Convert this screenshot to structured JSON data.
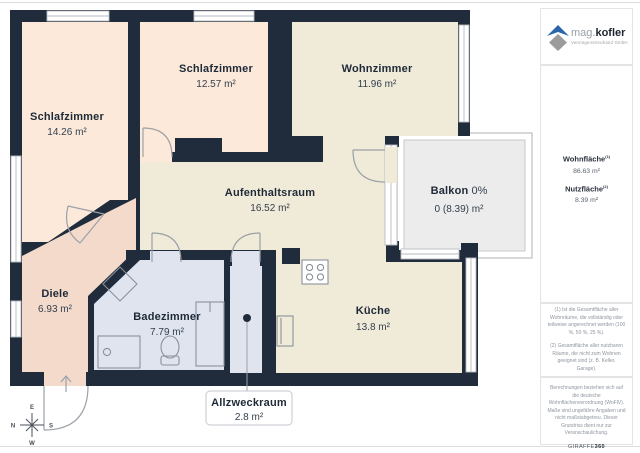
{
  "plan": {
    "rooms": [
      {
        "id": "schlafzimmer-1",
        "name": "Schlafzimmer",
        "area": "14.26 m²"
      },
      {
        "id": "schlafzimmer-2",
        "name": "Schlafzimmer",
        "area": "12.57 m²"
      },
      {
        "id": "wohnzimmer",
        "name": "Wohnzimmer",
        "area": "11.96 m²"
      },
      {
        "id": "aufenthaltsraum",
        "name": "Aufenthaltsraum",
        "area": "16.52 m²"
      },
      {
        "id": "balkon",
        "name": "Balkon",
        "percent": " 0%",
        "area": "0 (8.39) m²"
      },
      {
        "id": "diele",
        "name": "Diele",
        "area": "6.93 m²"
      },
      {
        "id": "badezimmer",
        "name": "Badezimmer",
        "area": "7.79 m²"
      },
      {
        "id": "kueche",
        "name": "Küche",
        "area": "13.8 m²"
      },
      {
        "id": "allzweckraum",
        "name": "Allzweckraum",
        "area": "2.8 m²"
      }
    ],
    "compass": {
      "n": "N",
      "e": "E",
      "s": "S",
      "w": "W"
    }
  },
  "sidebar": {
    "logo": {
      "brand_light": "mag.",
      "brand_bold": "kofler",
      "subtitle": "Vermögenstreuhand GmbH"
    },
    "metrics": [
      {
        "label": "Wohnfläche",
        "sup": "(1)",
        "value": "86.63 m²"
      },
      {
        "label": "Nutzfläche",
        "sup": "(2)",
        "value": "8.39 m²"
      }
    ],
    "footnotes": [
      "(1) Ist die Gesamtfläche aller Wohnräume, die vollständig oder teilweise angerechnet werden (100 %, 50 %, 25 %).",
      "(2) Gesamtfläche aller nutzbaren Räume, die nicht zum Wohnen geeignet sind (z. B. Keller, Garage)."
    ],
    "disclaimer": "Berechnungen beziehen sich auf die deutsche Wohnflächenverordnung (WoFlV). Maße sind ungefähre Angaben und nicht maßstabgetreu. Dieser Grundriss dient nur zur Veranschaulichung.",
    "brand_footer": {
      "name": "GIRAFFE",
      "suffix": "360"
    }
  },
  "colors": {
    "wall": "#202c3c",
    "bedroom": "#fce9d9",
    "living": "#f0ead8",
    "hall": "#f4dacb",
    "bath": "#dfe4ef",
    "balcony": "#ececec",
    "logo_blue": "#2b66ab",
    "logo_gray": "#9b9b9b"
  }
}
